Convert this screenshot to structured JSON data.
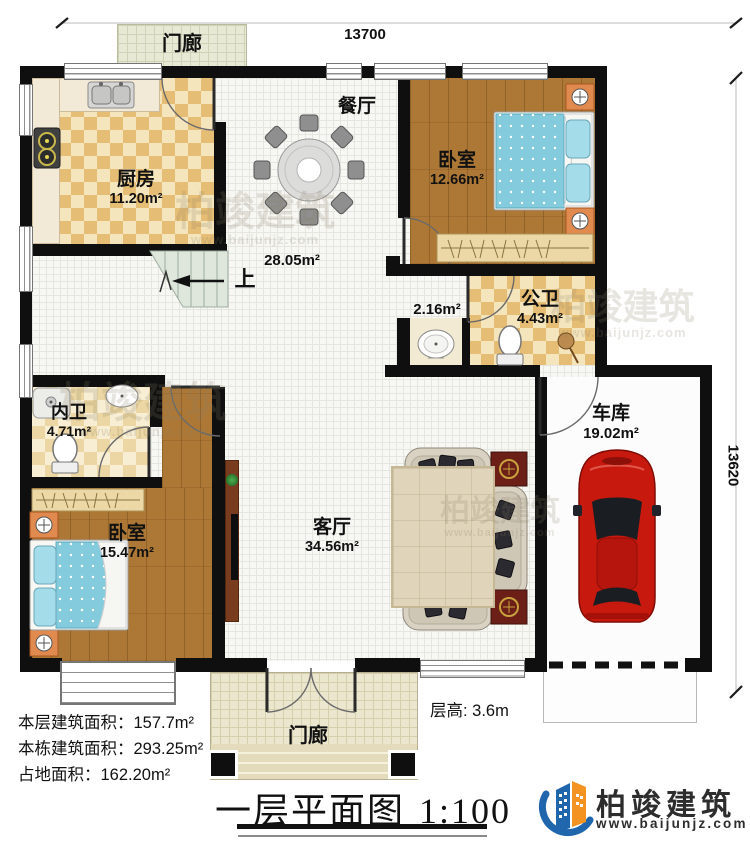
{
  "dimensions": {
    "top": "13700",
    "right": "13620"
  },
  "rooms": {
    "porch_top": {
      "name": "门廊"
    },
    "kitchen": {
      "name": "厨房",
      "area": "11.20m²"
    },
    "dining": {
      "name": "餐厅",
      "area": "28.05m²"
    },
    "bedroom_top": {
      "name": "卧室",
      "area": "12.66m²"
    },
    "bath_public": {
      "name": "公卫",
      "area": "4.43m²"
    },
    "wash_nook": {
      "area": "2.16m²"
    },
    "bath_inner": {
      "name": "内卫",
      "area": "4.71m²"
    },
    "bedroom_bottom": {
      "name": "卧室",
      "area": "15.47m²"
    },
    "living": {
      "name": "客厅",
      "area": "34.56m²"
    },
    "garage": {
      "name": "车库",
      "area": "19.02m²"
    },
    "porch_bottom": {
      "name": "门廊"
    },
    "stairs": {
      "label": "上"
    }
  },
  "stats": {
    "floor_area_label": "本层建筑面积：",
    "floor_area_value": "157.7m²",
    "building_area_label": "本栋建筑面积：",
    "building_area_value": "293.25m²",
    "footprint_label": "占地面积：",
    "footprint_value": "162.20m²",
    "floor_height": "层高: 3.6m"
  },
  "title_block": {
    "title": "一层平面图",
    "scale": "1:100"
  },
  "brand": {
    "name": "柏竣建筑",
    "url": "www.baijunjz.com"
  },
  "watermark": {
    "text": "柏竣建筑",
    "url": "www.baijunjz.com"
  },
  "colors": {
    "accent_blue": "#1f66ad",
    "accent_orange": "#f39422",
    "wall": "#0f0f0f"
  }
}
